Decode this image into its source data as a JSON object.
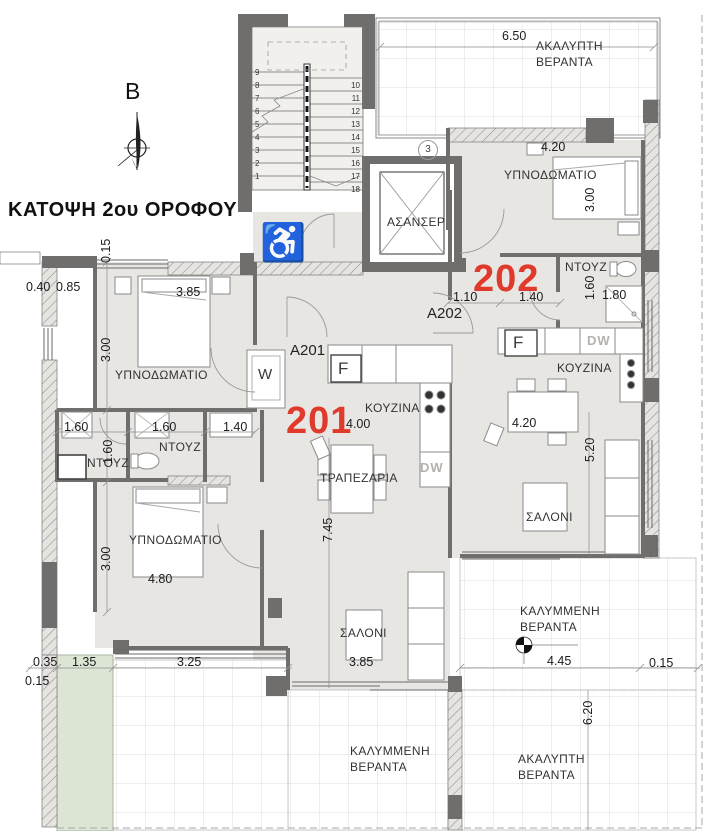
{
  "title": "ΚΑΤΟΨΗ 2ου ΟΡΟΦΟΥ",
  "compass": {
    "north_label": "B"
  },
  "apartments": {
    "a201": {
      "number": "201",
      "code": "A201"
    },
    "a202": {
      "number": "202",
      "code": "A202"
    }
  },
  "rooms": {
    "elevator": "ΑΣΑΝΣΕΡ",
    "bedroom_202": "ΥΠΝΟΔΩΜΑΤΙΟ",
    "shower_202": "ΝΤΟΥΖ",
    "kitchen_202": "ΚΟΥΖΙΝΑ",
    "living_202": "ΣΑΛΟΝΙ",
    "bedroom_201_front": "ΥΠΝΟΔΩΜΑΤΙΟ",
    "shower_201_a": "ΝΤΟΥΖ",
    "shower_201_b": "ΝΤΟΥΖ",
    "bedroom_201_back": "ΥΠΝΟΔΩΜΑΤΙΟ",
    "kitchen_201": "ΚΟΥΖΙΝΑ",
    "dining_201": "ΤΡΑΠΕΖΑΡΙΑ",
    "living_201": "ΣΑΛΟΝΙ"
  },
  "verandas": {
    "uncovered_top": {
      "line1": "ΑΚΑΛΥΠΤΗ",
      "line2": "ΒΕΡΑΝΤΑ"
    },
    "covered_right": {
      "line1": "ΚΑΛΥΜΜΕΝΗ",
      "line2": "ΒΕΡΑΝΤΑ"
    },
    "covered_bottom": {
      "line1": "ΚΑΛΥΜΜΕΝΗ",
      "line2": "ΒΕΡΑΝΤΑ"
    },
    "uncovered_bottom": {
      "line1": "ΑΚΑΛΥΠΤΗ",
      "line2": "ΒΕΡΑΝΤΑ"
    }
  },
  "appliances": {
    "washer": "W",
    "fridge_201": "F",
    "fridge_202": "F",
    "dishwasher_201": "DW",
    "dishwasher_202": "DW"
  },
  "grid_marker": "3",
  "accessible_icon": "♿",
  "stairs": {
    "left": [
      "9",
      "8",
      "7",
      "6",
      "5",
      "4",
      "3",
      "2",
      "1"
    ],
    "right": [
      "10",
      "11",
      "12",
      "13",
      "14",
      "15",
      "16",
      "17",
      "18"
    ]
  },
  "dimensions": {
    "veranda_top_width": "6.50",
    "bedroom202_width": "4.20",
    "bedroom202_depth": "3.00",
    "shower202_depth": "1.60",
    "shower202_width": "1.80",
    "hall202_a": "1.10",
    "hall202_b": "1.40",
    "west_offset_a": "0.40",
    "west_offset_b": "0.85",
    "bedroom201f_width": "3.85",
    "bedroom201f_depth": "3.00",
    "north_wall": "0.15",
    "shower_a_width": "1.60",
    "shower_b_width": "1.60",
    "wc_width": "1.40",
    "shower_depth": "1.60",
    "kitchen201_width": "4.00",
    "living201_length": "7.45",
    "bedroom201b_width": "4.80",
    "bedroom201b_depth": "3.00",
    "living201_width": "3.85",
    "dining202_width": "4.20",
    "living202_depth": "5.20",
    "veranda_right_width": "4.45",
    "east_offset": "0.15",
    "veranda_right_length": "6.20",
    "sw_offset_a": "0.35",
    "sw_planter": "1.35",
    "sw_width": "3.25",
    "sw_offset_b": "0.15"
  },
  "colors": {
    "apartment_number": "#e03a2c",
    "wall_dark": "#6f6e6c",
    "floor": "#e8e6e3",
    "planter": "#dde6d5"
  }
}
